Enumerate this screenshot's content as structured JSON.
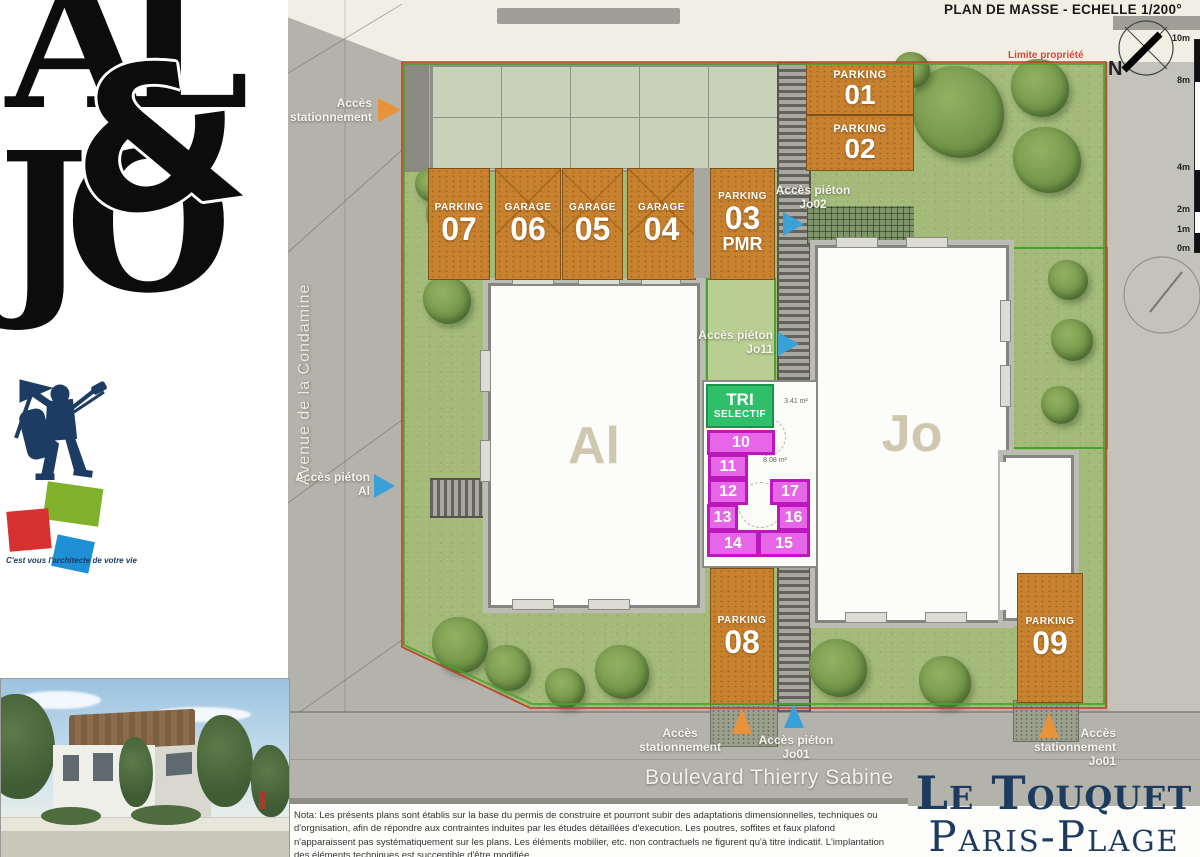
{
  "header": {
    "title": "PLAN DE MASSE - ECHELLE 1/200°",
    "property_line": "Limite propriété",
    "north": "N",
    "scale_labels": [
      "10m",
      "8m",
      "4m",
      "2m",
      "1m",
      "0m"
    ]
  },
  "streets": {
    "avenue": "Avenue de la Condamine",
    "boulevard": "Boulevard Thierry Sabine"
  },
  "brand": {
    "logo_top": "AL",
    "logo_amp": "&",
    "logo_bottom": "JO",
    "tagline": "C'est vous l'architecte de votre vie"
  },
  "buildings": {
    "left": "Al",
    "right": "Jo"
  },
  "plan": {
    "spots": [
      {
        "type": "PARKING",
        "num": "01"
      },
      {
        "type": "PARKING",
        "num": "02"
      },
      {
        "type": "PARKING",
        "num": "03",
        "suffix": "PMR"
      },
      {
        "type": "GARAGE",
        "num": "04"
      },
      {
        "type": "GARAGE",
        "num": "05"
      },
      {
        "type": "GARAGE",
        "num": "06"
      },
      {
        "type": "PARKING",
        "num": "07"
      },
      {
        "type": "PARKING",
        "num": "08"
      },
      {
        "type": "PARKING",
        "num": "09"
      }
    ],
    "tri_line1": "TRI",
    "tri_line2": "SELECTIF",
    "stalls": [
      "10",
      "11",
      "12",
      "13",
      "14",
      "15",
      "16",
      "17"
    ],
    "areas": {
      "top": "3.41 m²",
      "mid": "8.08 m²"
    }
  },
  "access": {
    "west_parking": "Accès\nstationnement",
    "jo02": "Accès piéton\nJo02",
    "jo11": "Accès piéton\nJo11",
    "al": "Accès piéton\nAl",
    "south_parking": "Accès\nstationnement",
    "jo01": "Accès piéton\nJo01",
    "southeast_parking": "Accès\nstationnement\nJo01"
  },
  "footer": {
    "nota": "Nota: Les présents plans sont établis sur la base du permis de construire et pourront subir des adaptations dimensionnelles, techniques ou d'orgnisation, afin de répondre aux contraintes induites par les études détaillées d'execution. Les poutres, soffites et faux plafond n'apparaissent pas systématiquement sur les plans. Les éléments mobilier, etc. non contractuels ne figurent qu'à titre indicatif. L'implantation des éléments techniques est succeptible d'être modifiée.",
    "city_line1": "Le Touquet",
    "city_line2": "Paris-Plage"
  },
  "colors": {
    "parking_orange": "#c8822f",
    "stall_magenta": "#e765e7",
    "tri_green": "#2fbf6b",
    "arrow_blue": "#3aa0d8",
    "arrow_orange": "#e8923a",
    "property_red": "#c23b2e",
    "brand_navy": "#1d3c63"
  }
}
